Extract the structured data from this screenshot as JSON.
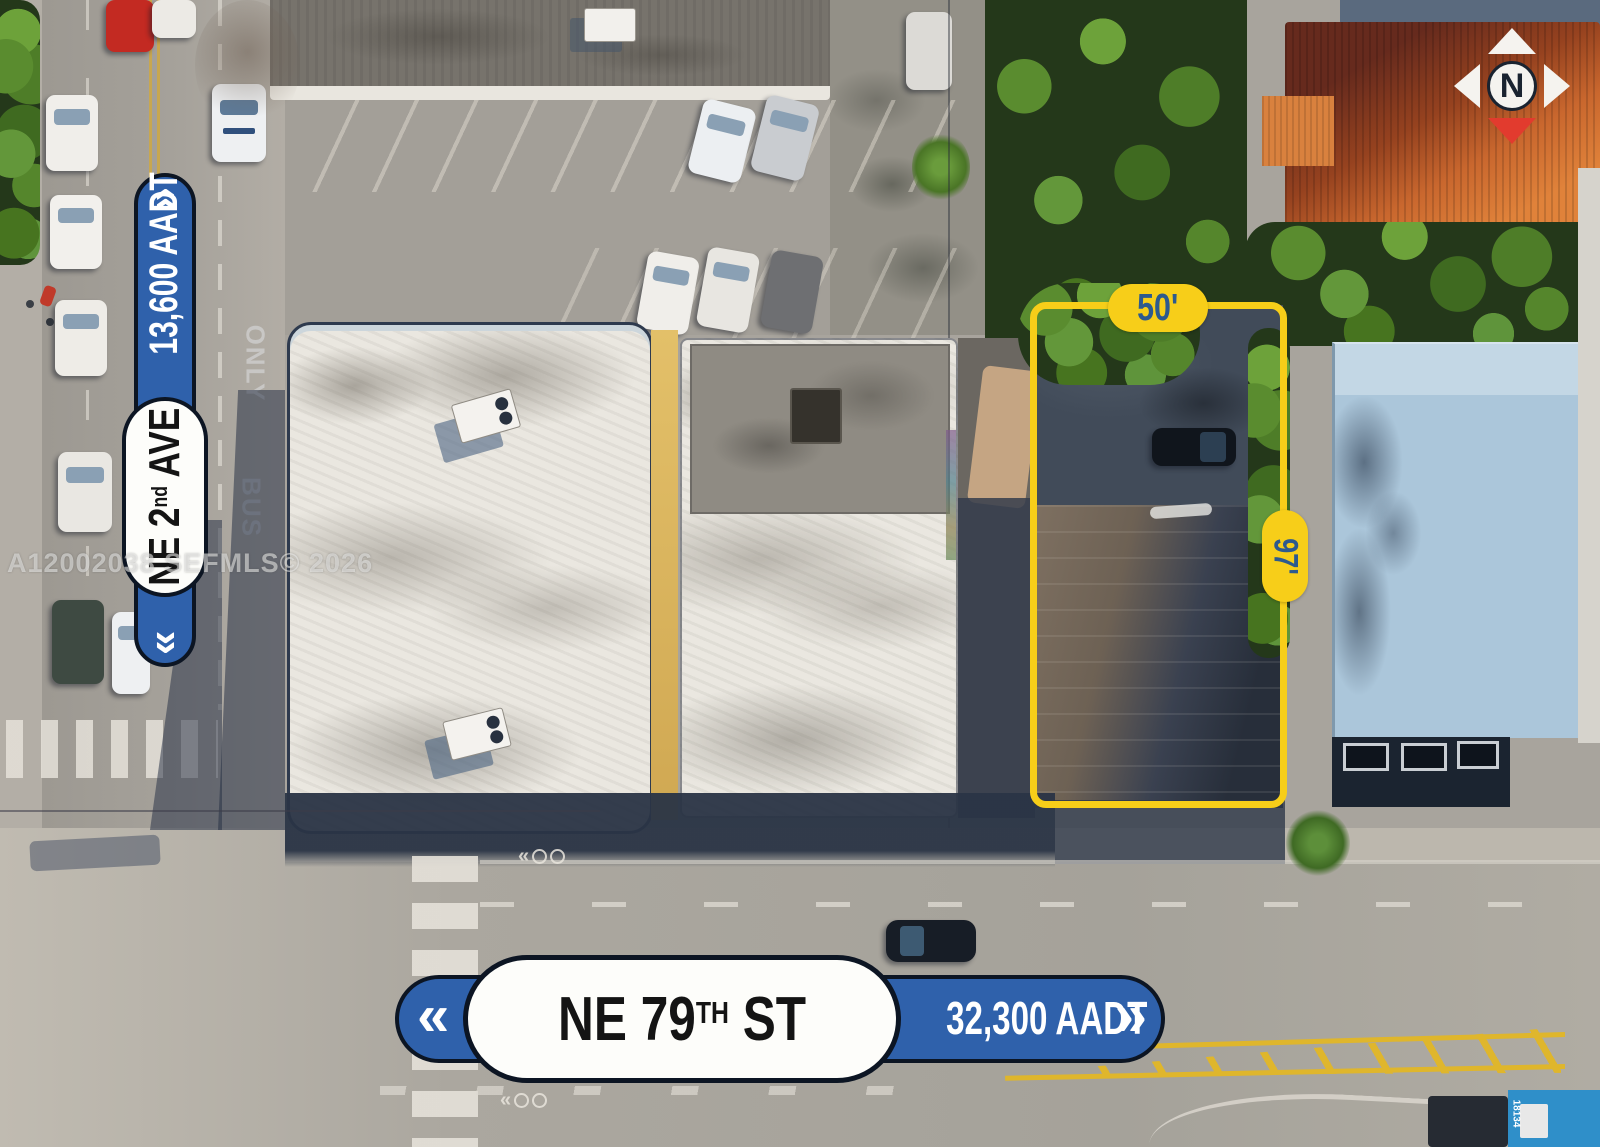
{
  "annotations": {
    "compass": {
      "letter": "N"
    },
    "vertical_street": {
      "chevron_top": "»",
      "aadt": "13,600 AADT",
      "name_prefix": "NE 2",
      "name_ordinal": "nd",
      "name_suffix": " AVE",
      "chevron_bottom": "«"
    },
    "horizontal_street": {
      "chevron_left": "«",
      "name_prefix": "NE 79",
      "name_ordinal": "TH",
      "name_suffix": " ST",
      "aadt": "32,300 AADT",
      "chevron_right": "»"
    },
    "lot": {
      "frontage_label": "50'",
      "depth_label": "97'"
    }
  },
  "watermark": "A12002038 SEFMLS© 2026",
  "scene": {
    "road_text_only": "ONLY",
    "road_text_bus": "BUS",
    "road_chevron": "«",
    "truck_number": "18134"
  },
  "colors": {
    "sign_blue": "#2f61ab",
    "sign_outline": "#0c1523",
    "annotation_yellow": "#f7ce19",
    "dimension_text_blue": "#2d5a8e",
    "compass_red": "#e23b2e"
  }
}
